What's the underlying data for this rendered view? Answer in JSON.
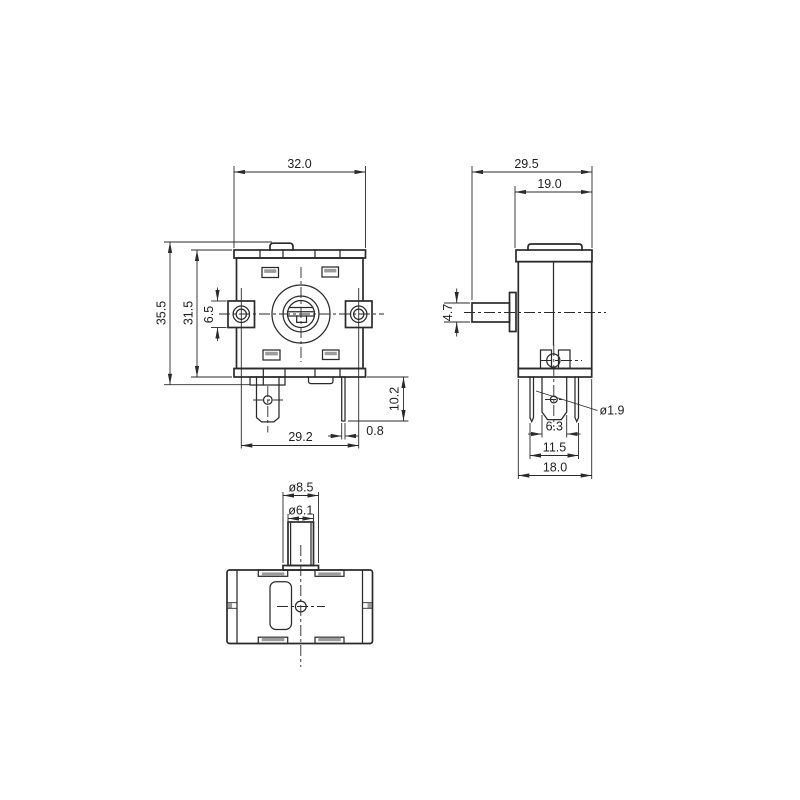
{
  "colors": {
    "background": "#ffffff",
    "line": "#2a2a2a",
    "text": "#1f1f1f",
    "shade": "#9b9b9b"
  },
  "views": {
    "front": {
      "dims": {
        "body_width": "32.0",
        "total_height": "35.5",
        "body_height": "31.5",
        "ear_height": "6.5",
        "ear_hole_spacing": "29.2",
        "pin_thickness": "0.8",
        "pin_length": "10.2"
      }
    },
    "side": {
      "dims": {
        "total_depth": "29.5",
        "body_depth": "19.0",
        "shaft_height": "4.7",
        "tab_hole_diameter": "ø1.9",
        "tab_width": "6.3",
        "pin_span": "11.5",
        "base_depth": "18.0"
      }
    },
    "bottom": {
      "dims": {
        "bushing_diameter": "ø8.5",
        "shaft_diameter": "ø6.1"
      }
    }
  }
}
